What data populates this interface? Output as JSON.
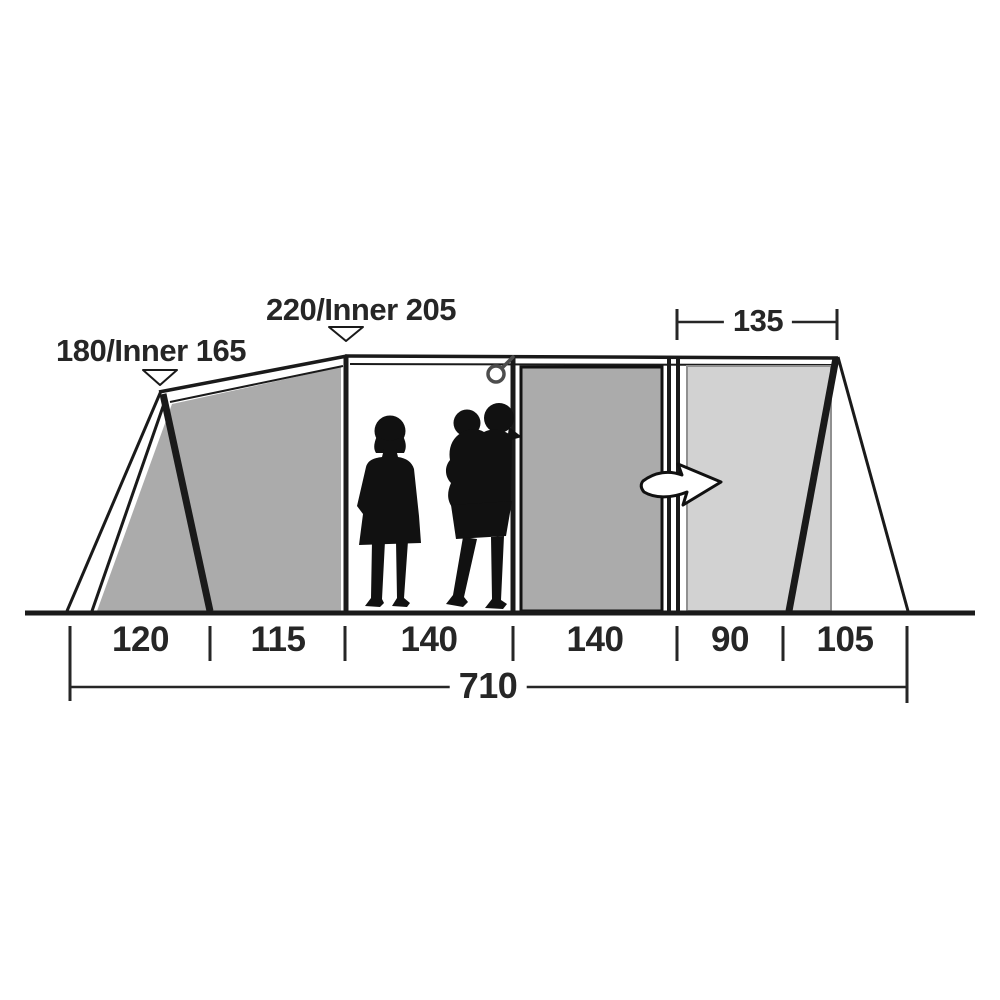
{
  "diagram": {
    "left_height_label": "180/Inner 165",
    "center_height_label": "220/Inner 205",
    "right_door_width_label": "135",
    "segment_widths": [
      "120",
      "115",
      "140",
      "140",
      "90",
      "105"
    ],
    "total_width_label": "710",
    "icons": {
      "left_height_marker": "triangle-down-icon",
      "center_height_marker": "triangle-down-icon",
      "door_direction": "curved-right-arrow-icon",
      "ceiling_attachment": "hanging-ring-icon"
    },
    "colors": {
      "panel_mid_gray": "#ababab",
      "panel_light_gray": "#d2d2d2",
      "outline_black": "#1a1a1a",
      "text": "#262626"
    }
  }
}
